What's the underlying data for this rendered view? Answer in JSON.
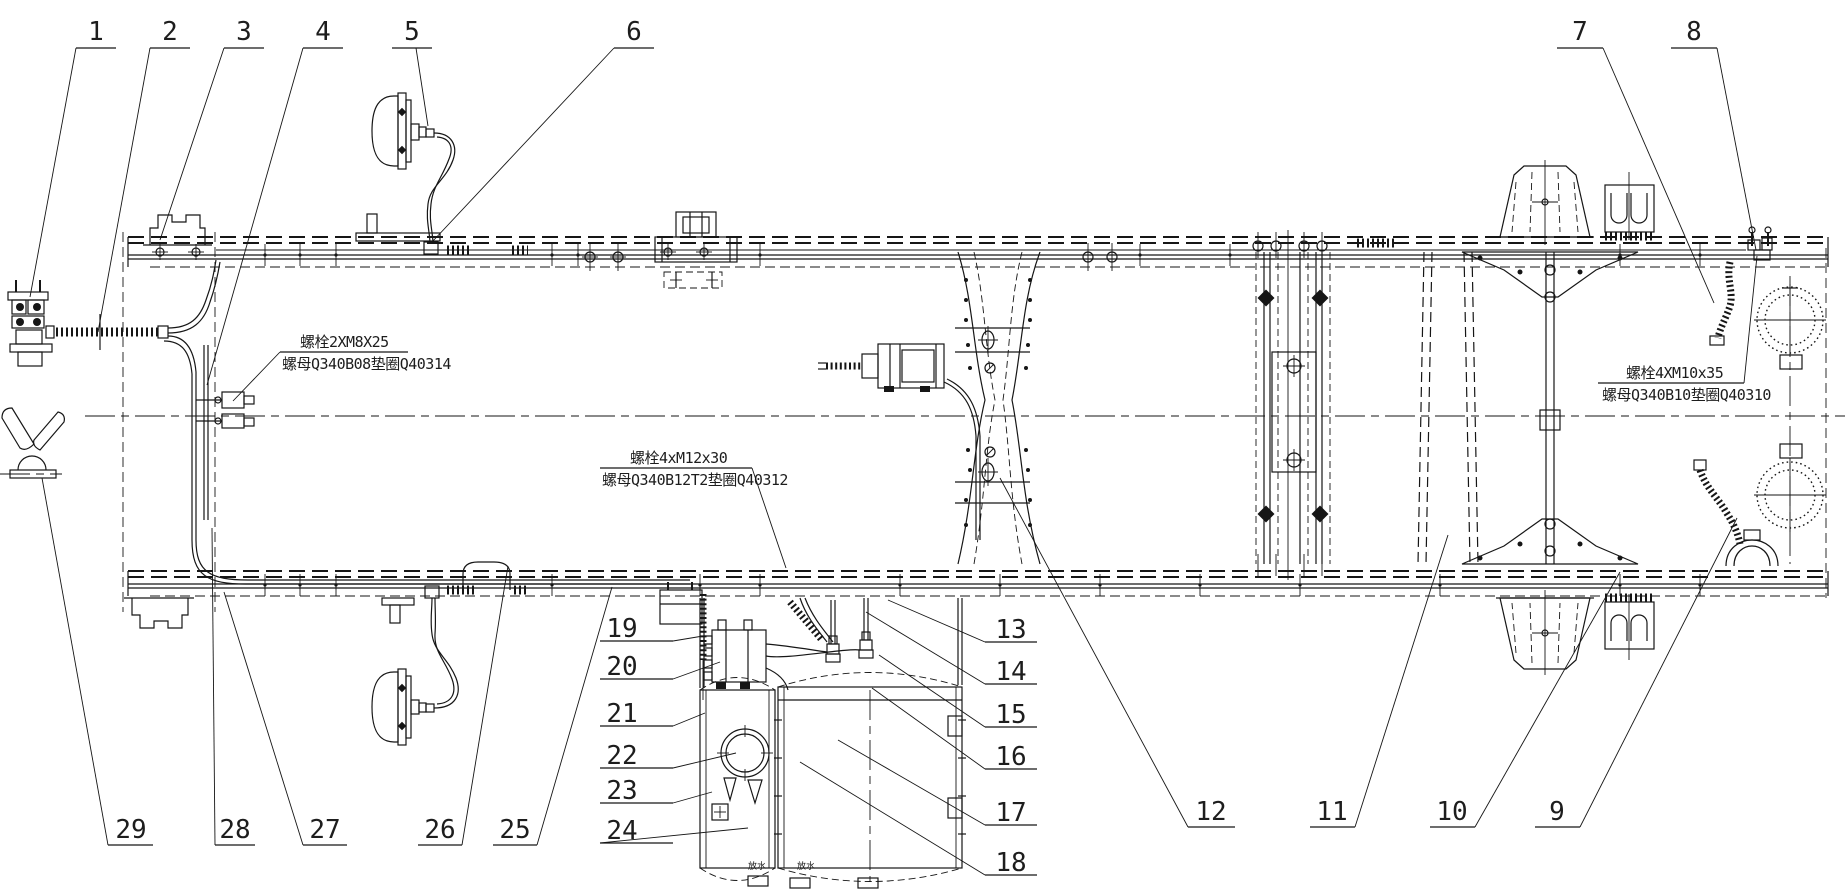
{
  "colors": {
    "background": "#ffffff",
    "ink": "#161616"
  },
  "callouts": [
    {
      "label": "1",
      "tx": 96,
      "ty": 40,
      "ul": [
        76,
        116,
        48
      ],
      "leader": [
        [
          76,
          48
        ],
        [
          30,
          297
        ]
      ]
    },
    {
      "label": "2",
      "tx": 170,
      "ty": 40,
      "ul": [
        150,
        190,
        48
      ],
      "leader": [
        [
          150,
          48
        ],
        [
          98,
          332
        ]
      ]
    },
    {
      "label": "3",
      "tx": 244,
      "ty": 40,
      "ul": [
        224,
        264,
        48
      ],
      "leader": [
        [
          224,
          48
        ],
        [
          160,
          240
        ]
      ]
    },
    {
      "label": "4",
      "tx": 323,
      "ty": 40,
      "ul": [
        303,
        343,
        48
      ],
      "leader": [
        [
          303,
          48
        ],
        [
          207,
          385
        ]
      ]
    },
    {
      "label": "5",
      "tx": 412,
      "ty": 40,
      "ul": [
        392,
        432,
        48
      ],
      "leader": [
        [
          416,
          48
        ],
        [
          428,
          126
        ]
      ]
    },
    {
      "label": "6",
      "tx": 634,
      "ty": 40,
      "ul": [
        614,
        654,
        48
      ],
      "leader": [
        [
          614,
          48
        ],
        [
          432,
          242
        ]
      ]
    },
    {
      "label": "7",
      "tx": 1580,
      "ty": 40,
      "ul": [
        1557,
        1603,
        48
      ],
      "leader": [
        [
          1603,
          48
        ],
        [
          1714,
          303
        ]
      ]
    },
    {
      "label": "8",
      "tx": 1694,
      "ty": 40,
      "ul": [
        1671,
        1717,
        48
      ],
      "leader": [
        [
          1717,
          48
        ],
        [
          1756,
          250
        ]
      ]
    },
    {
      "label": "9",
      "tx": 1557,
      "ty": 820,
      "ul": [
        1535,
        1580,
        827
      ],
      "leader": [
        [
          1580,
          827
        ],
        [
          1737,
          518
        ]
      ]
    },
    {
      "label": "10",
      "tx": 1452,
      "ty": 820,
      "ul": [
        1430,
        1475,
        827
      ],
      "leader": [
        [
          1475,
          827
        ],
        [
          1620,
          572
        ]
      ]
    },
    {
      "label": "11",
      "tx": 1332,
      "ty": 820,
      "ul": [
        1310,
        1355,
        827
      ],
      "leader": [
        [
          1355,
          827
        ],
        [
          1448,
          535
        ]
      ]
    },
    {
      "label": "12",
      "tx": 1211,
      "ty": 820,
      "ul": [
        1188,
        1235,
        827
      ],
      "leader": [
        [
          1188,
          827
        ],
        [
          1000,
          478
        ]
      ]
    },
    {
      "label": "13",
      "tx": 1011,
      "ty": 638,
      "ul": [
        985,
        1037,
        642
      ],
      "leader": [
        [
          985,
          642
        ],
        [
          888,
          600
        ]
      ]
    },
    {
      "label": "14",
      "tx": 1011,
      "ty": 680,
      "ul": [
        985,
        1037,
        684
      ],
      "leader": [
        [
          985,
          684
        ],
        [
          866,
          612
        ]
      ]
    },
    {
      "label": "15",
      "tx": 1011,
      "ty": 723,
      "ul": [
        985,
        1037,
        727
      ],
      "leader": [
        [
          985,
          727
        ],
        [
          879,
          655
        ]
      ]
    },
    {
      "label": "16",
      "tx": 1011,
      "ty": 765,
      "ul": [
        985,
        1037,
        769
      ],
      "leader": [
        [
          985,
          769
        ],
        [
          872,
          688
        ]
      ]
    },
    {
      "label": "17",
      "tx": 1011,
      "ty": 821,
      "ul": [
        985,
        1037,
        825
      ],
      "leader": [
        [
          985,
          825
        ],
        [
          838,
          740
        ]
      ]
    },
    {
      "label": "18",
      "tx": 1011,
      "ty": 871,
      "ul": [
        985,
        1037,
        875
      ],
      "leader": [
        [
          985,
          875
        ],
        [
          800,
          762
        ]
      ]
    },
    {
      "label": "19",
      "tx": 622,
      "ty": 637,
      "ul": [
        600,
        673,
        641
      ],
      "leader": [
        [
          673,
          641
        ],
        [
          703,
          636
        ]
      ]
    },
    {
      "label": "20",
      "tx": 622,
      "ty": 675,
      "ul": [
        600,
        673,
        679
      ],
      "leader": [
        [
          673,
          679
        ],
        [
          720,
          662
        ]
      ]
    },
    {
      "label": "21",
      "tx": 622,
      "ty": 722,
      "ul": [
        600,
        673,
        726
      ],
      "leader": [
        [
          673,
          726
        ],
        [
          705,
          713
        ]
      ]
    },
    {
      "label": "22",
      "tx": 622,
      "ty": 764,
      "ul": [
        600,
        673,
        768
      ],
      "leader": [
        [
          673,
          768
        ],
        [
          736,
          753
        ]
      ]
    },
    {
      "label": "23",
      "tx": 622,
      "ty": 799,
      "ul": [
        600,
        673,
        803
      ],
      "leader": [
        [
          673,
          803
        ],
        [
          712,
          792
        ]
      ]
    },
    {
      "label": "24",
      "tx": 622,
      "ty": 839,
      "ul": [
        600,
        673,
        843
      ],
      "leader": [
        [
          600,
          843
        ],
        [
          748,
          828
        ]
      ]
    },
    {
      "label": "25",
      "tx": 515,
      "ty": 838,
      "ul": [
        493,
        537,
        845
      ],
      "leader": [
        [
          537,
          845
        ],
        [
          612,
          587
        ]
      ]
    },
    {
      "label": "26",
      "tx": 440,
      "ty": 838,
      "ul": [
        418,
        462,
        845
      ],
      "leader": [
        [
          462,
          845
        ],
        [
          508,
          566
        ]
      ]
    },
    {
      "label": "27",
      "tx": 325,
      "ty": 838,
      "ul": [
        303,
        347,
        845
      ],
      "leader": [
        [
          303,
          845
        ],
        [
          224,
          592
        ]
      ]
    },
    {
      "label": "28",
      "tx": 235,
      "ty": 838,
      "ul": [
        215,
        255,
        845
      ],
      "leader": [
        [
          215,
          845
        ],
        [
          212,
          528
        ]
      ]
    },
    {
      "label": "29",
      "tx": 131,
      "ty": 838,
      "ul": [
        108,
        153,
        845
      ],
      "leader": [
        [
          108,
          845
        ],
        [
          42,
          478
        ]
      ]
    }
  ],
  "notes": [
    {
      "id": "bolt-note-front",
      "line1": "螺栓2XM8X25",
      "line2": "螺母Q340B08垫圈Q40314",
      "x1": 300,
      "y1": 347,
      "x2": 282,
      "y2": 369,
      "ul": [
        280,
        408,
        352
      ],
      "leader": [
        [
          280,
          352
        ],
        [
          233,
          401
        ]
      ]
    },
    {
      "id": "bolt-note-middle",
      "line1": "螺栓4xM12x30",
      "line2": "螺母Q340B12T2垫圈Q40312",
      "x1": 630,
      "y1": 463,
      "x2": 602,
      "y2": 485,
      "ul": [
        600,
        752,
        468
      ],
      "leader": [
        [
          752,
          468
        ],
        [
          786,
          568
        ]
      ]
    },
    {
      "id": "bolt-note-rear",
      "line1": "螺栓4XM10x35",
      "line2": "螺母Q340B10垫圈Q40310",
      "x1": 1626,
      "y1": 378,
      "x2": 1602,
      "y2": 400,
      "ul": [
        1598,
        1744,
        383
      ],
      "leader": [
        [
          1744,
          383
        ],
        [
          1757,
          256
        ]
      ]
    }
  ],
  "tank_labels": [
    {
      "text": "放水",
      "x": 757,
      "y": 869
    },
    {
      "text": "放水",
      "x": 806,
      "y": 869
    }
  ]
}
